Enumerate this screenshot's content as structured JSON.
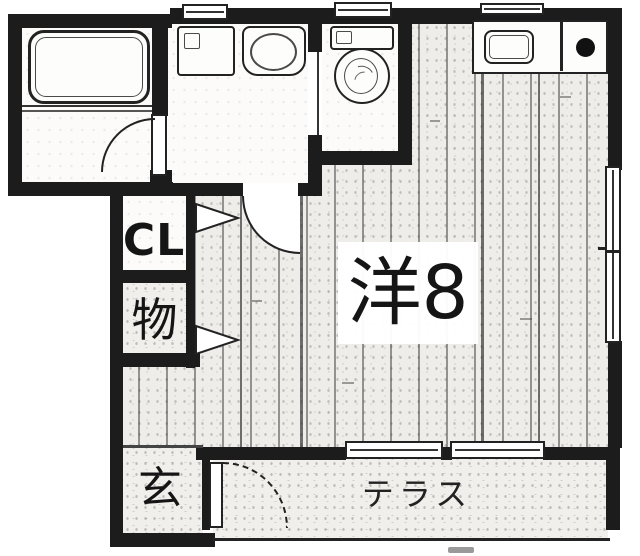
{
  "plan": {
    "name": "apartment floor plan",
    "labels": {
      "closet": "CL",
      "storage": "物",
      "main_room": "洋8",
      "entrance": "玄",
      "terrace": "テラス"
    },
    "fixtures": [
      "bathtub",
      "washing-machine-space",
      "vanity-sink",
      "toilet",
      "kitchen-sink",
      "stove-burner"
    ],
    "colors": {
      "wall": "#1c1c1c",
      "flooring": "#efede9",
      "paper": "#ffffff"
    }
  }
}
